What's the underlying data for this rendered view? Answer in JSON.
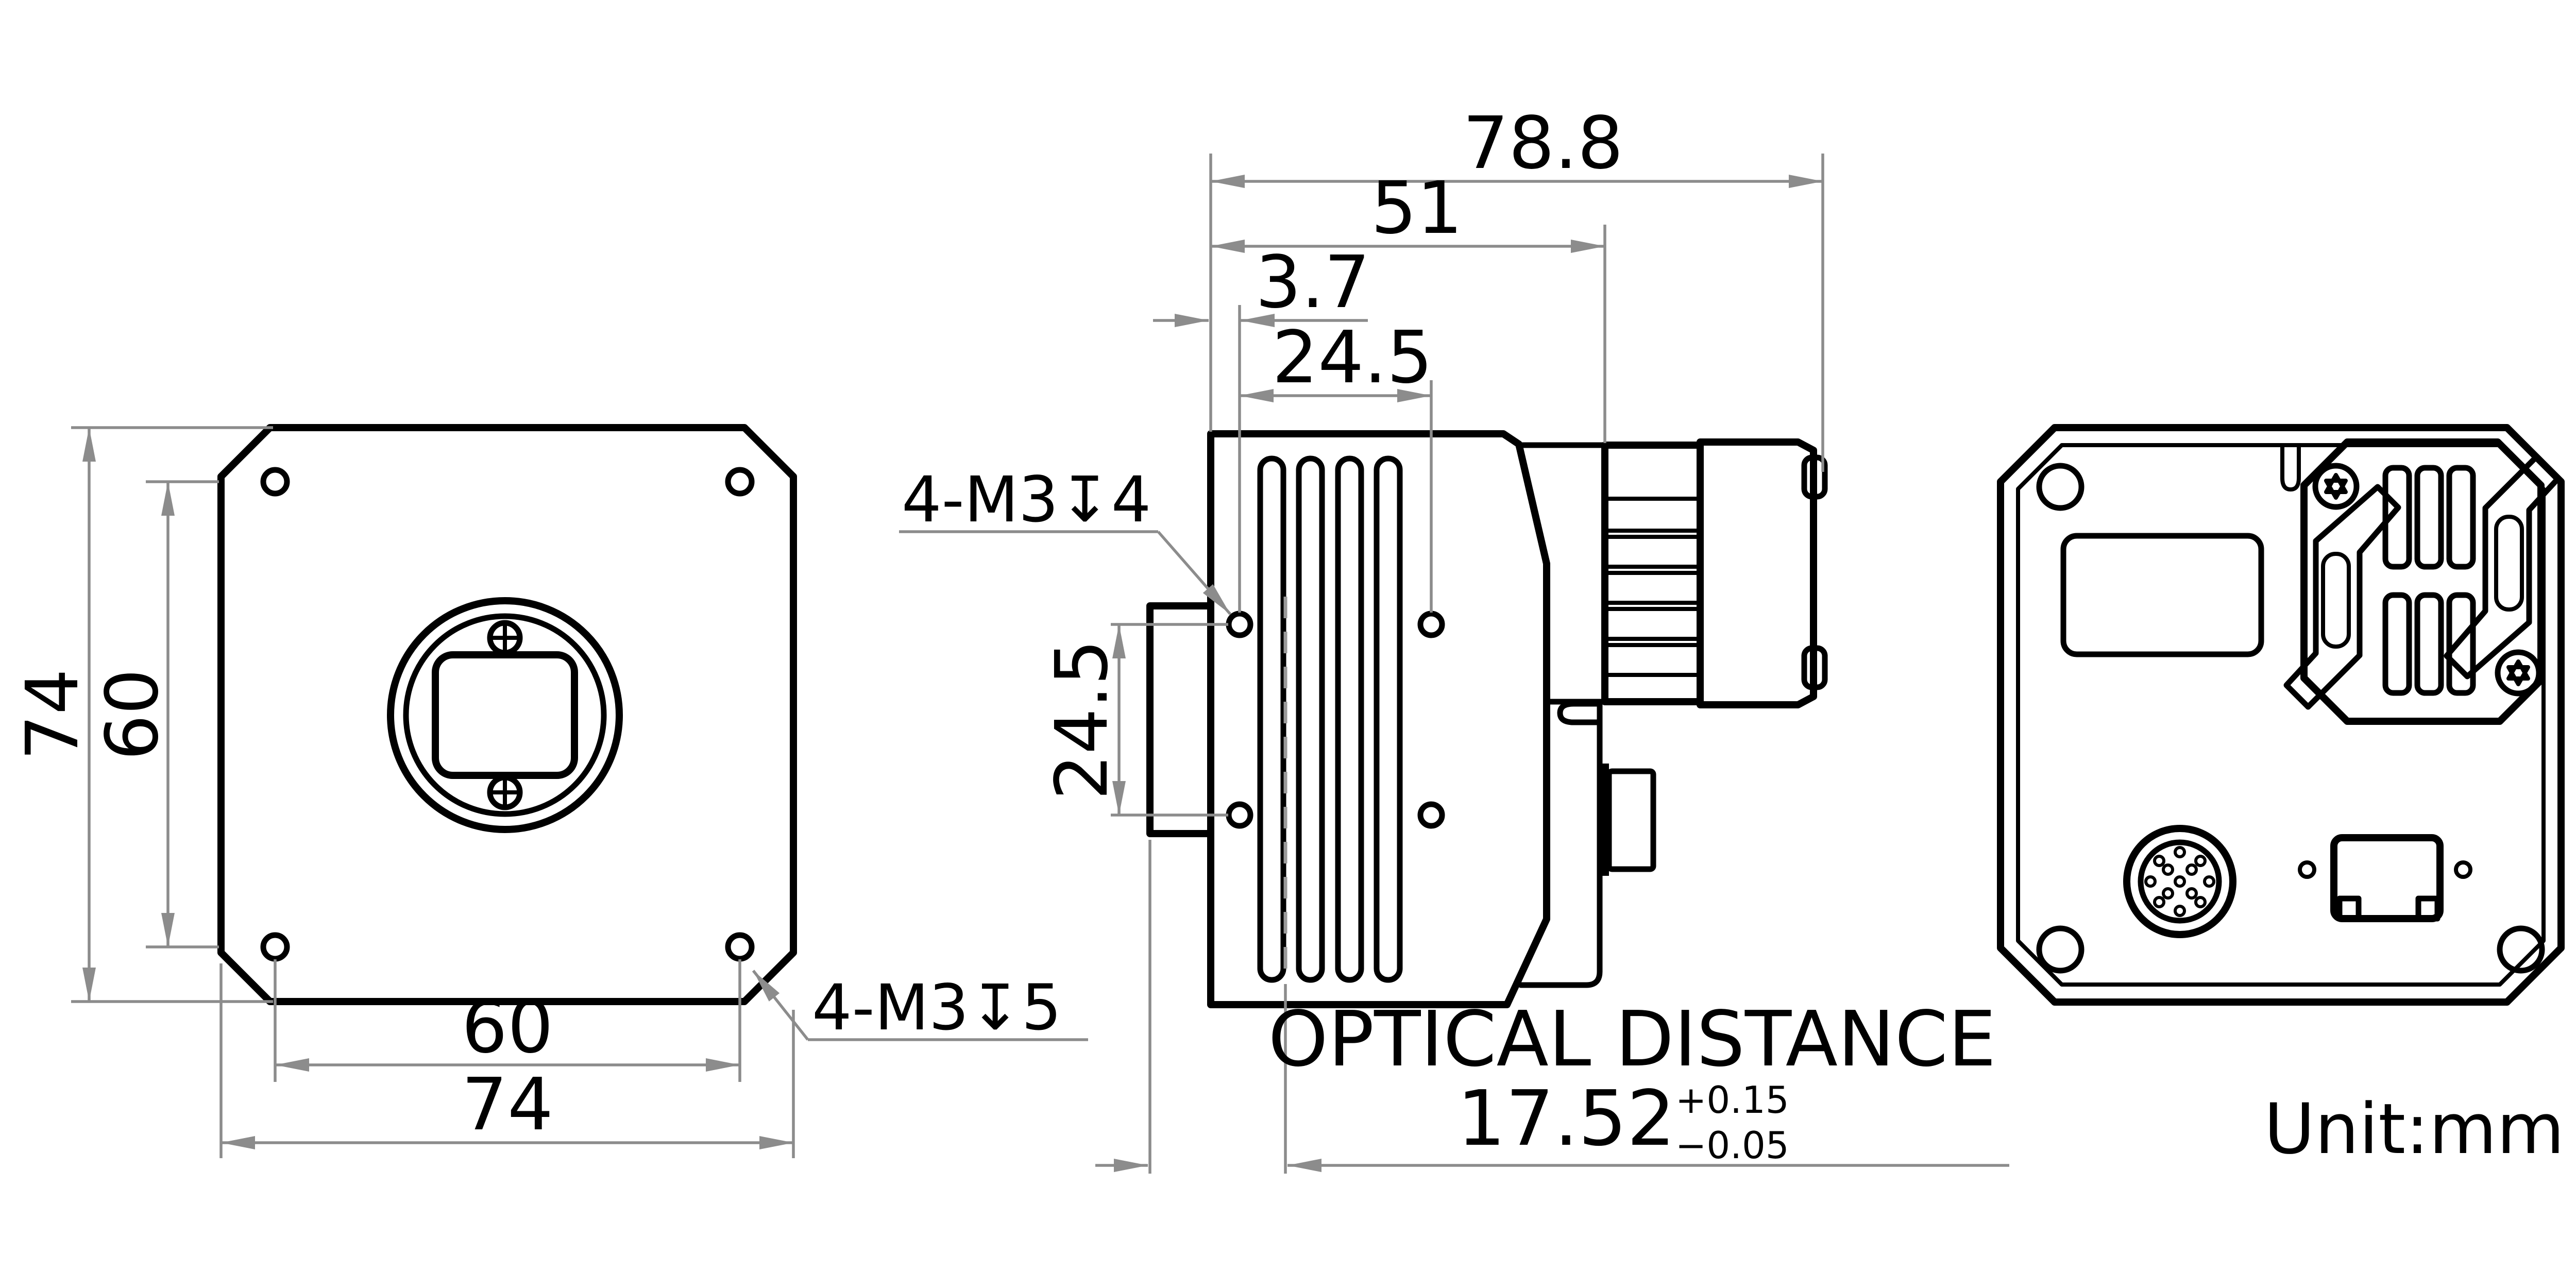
{
  "drawing": {
    "type": "mechanical dimensional drawing, three views of an industrial area-scan camera",
    "unit_label": "Unit:mm",
    "colors": {
      "outline": "#000000",
      "dimension_lines": "#8c8c8c",
      "background": "#ffffff"
    },
    "front_view": {
      "dim_outer_height": "74",
      "dim_hole_pitch_height": "60",
      "dim_hole_pitch_width": "60",
      "dim_outer_width": "74",
      "thread_callout": "4-M3↧5"
    },
    "side_view": {
      "dim_total_length": "78.8",
      "dim_body_length": "51",
      "dim_hole_offset": "3.7",
      "dim_hole_pitch_horizontal": "24.5",
      "dim_hole_pitch_vertical": "24.5",
      "thread_callout": "4-M3↧4",
      "optical_distance": {
        "label": "OPTICAL DISTANCE",
        "value": "17.52",
        "tolerance_upper": "+0.15",
        "tolerance_lower": "−0.05"
      }
    },
    "back_view": {}
  }
}
